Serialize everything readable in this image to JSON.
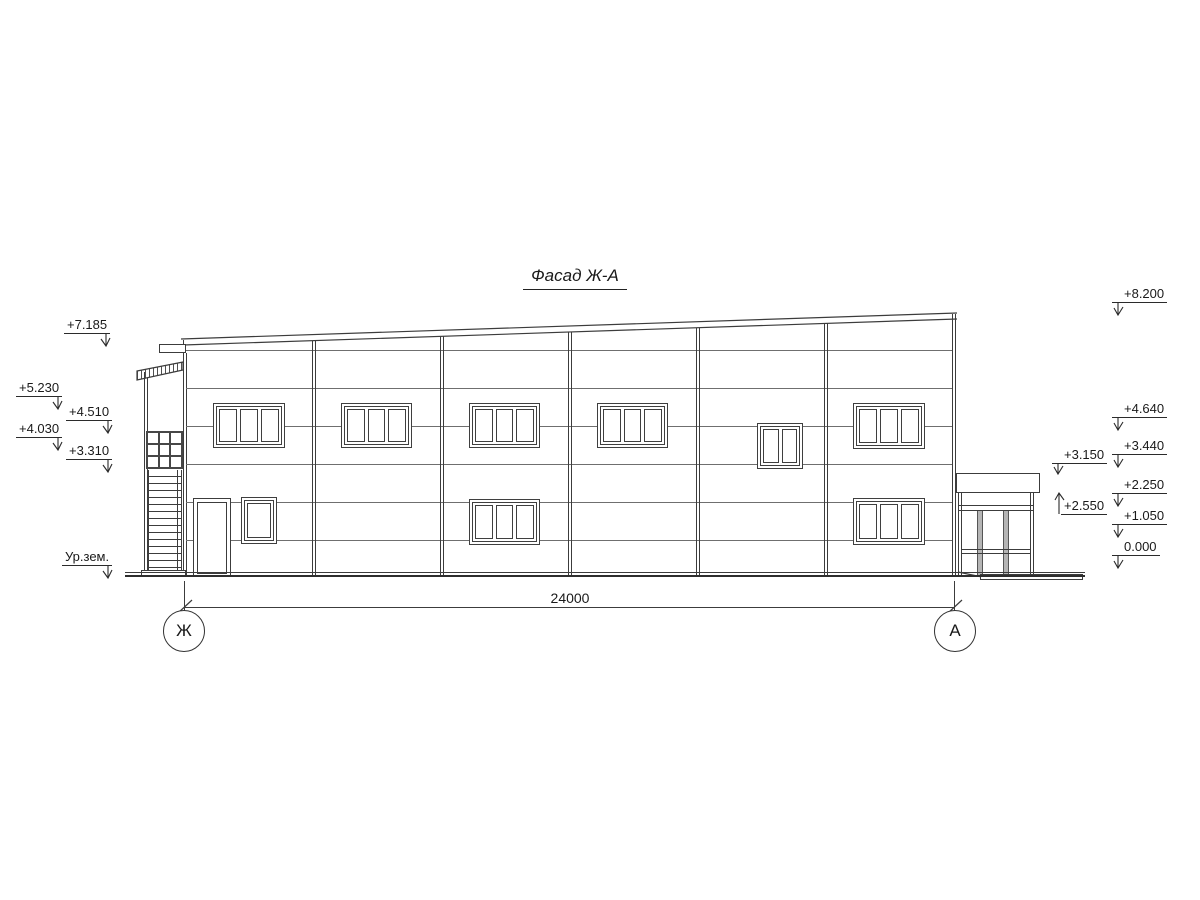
{
  "title": "Фасад Ж-А",
  "elevation_marks": {
    "left": [
      {
        "value": "+7.185"
      },
      {
        "value": "+5.230"
      },
      {
        "value": "+4.510"
      },
      {
        "value": "+4.030"
      },
      {
        "value": "+3.310"
      },
      {
        "value": "Ур.зем."
      }
    ],
    "right": [
      {
        "value": "+8.200"
      },
      {
        "value": "+4.640"
      },
      {
        "value": "+3.440"
      },
      {
        "value": "+2.250"
      },
      {
        "value": "+1.050"
      },
      {
        "value": "0.000"
      }
    ],
    "porch": [
      {
        "value": "+3.150"
      },
      {
        "value": "+2.550"
      }
    ]
  },
  "dimension": {
    "value": "24000"
  },
  "axes": [
    {
      "label": "Ж"
    },
    {
      "label": "А"
    }
  ],
  "colors": {
    "line": "#3c3c3c",
    "joint": "#6f6f6f",
    "background": "#ffffff"
  }
}
